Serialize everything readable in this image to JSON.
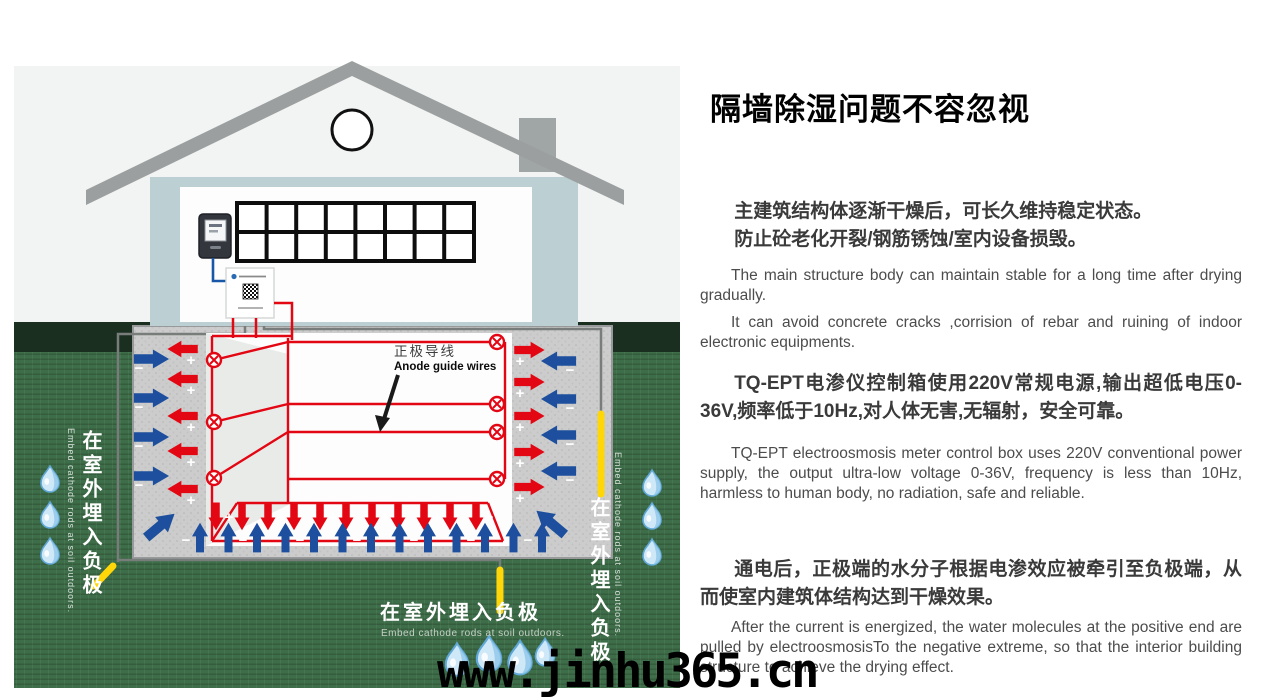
{
  "title": "隔墙除湿问题不容忽视",
  "sections": [
    {
      "zh_lines": [
        "主建筑结构体逐渐干燥后，可长久维持稳定状态。",
        "防止砼老化开裂/钢筋锈蚀/室内设备损毁。"
      ],
      "en_paras": [
        "The main structure body can maintain stable for a long time after drying gradually.",
        "It can avoid concrete cracks ,corrision of rebar and ruining of indoor electronic equipments."
      ]
    },
    {
      "zh_lines": [
        "TQ-EPT电渗仪控制箱使用220V常规电源,输出超低电压0-36V,频率低于10Hz,对人体无害,无辐射，安全可靠。"
      ],
      "en_paras": [
        "TQ-EPT electroosmosis meter control box uses 220V conventional power supply, the output ultra-low voltage 0-36V, frequency is less than 10Hz, harmless to human body, no radiation, safe and reliable."
      ]
    },
    {
      "zh_lines": [
        "通电后，正极端的水分子根据电渗效应被牵引至负极端，从而使室内建筑体结构达到干燥效果。"
      ],
      "en_paras": [
        "After the current is energized, the water molecules at the positive end are pulled by electroosmosisTo the negative extreme, so that the interior building structure to achieve the drying effect."
      ]
    }
  ],
  "diagram": {
    "anode_label_zh": "正极导线",
    "anode_label_en": "Anode guide wires",
    "cathode_label_zh": "在室外埋入负极",
    "cathode_label_en": "Embed cathode rods at soil outdoors.",
    "watermark": "www.jinhu365.cn",
    "colors": {
      "red": "#e30613",
      "blue": "#1d4f9e",
      "yellow": "#ffd608",
      "soil": "#3e6e49",
      "soil_dark_band": "#1a2f1f",
      "wall": "#bccfd3",
      "roof": "#9b9f9f",
      "foundation": "#cbcccb",
      "backdrop": "#f2f3f3"
    }
  },
  "symbols": {
    "plus": "+",
    "minus": "−"
  }
}
